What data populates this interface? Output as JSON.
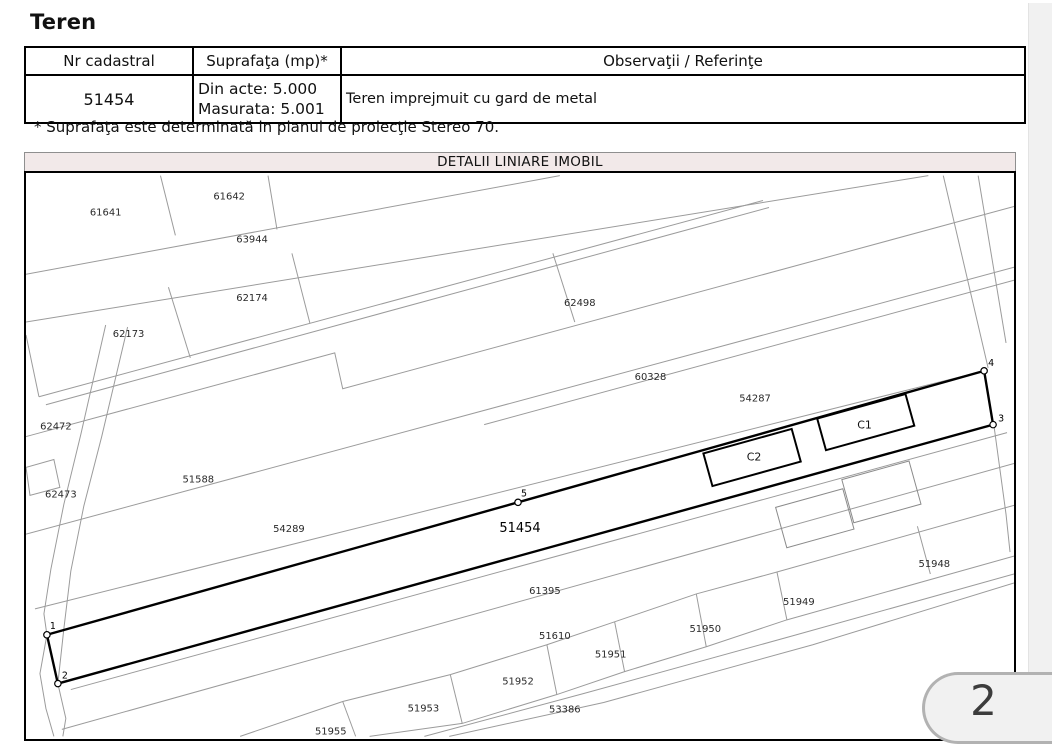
{
  "title": "Teren",
  "table": {
    "headers": [
      "Nr cadastral",
      "Suprafaţa (mp)*",
      "Observaţii / Referinţe"
    ],
    "row": {
      "nr_cadastral": "51454",
      "suprafata_line1": "Din acte: 5.000",
      "suprafata_line2": "Masurata: 5.001",
      "observatii": "Teren imprejmuit cu gard de metal"
    }
  },
  "footnote": "* Suprafaţa este determinată in planul de proiecţie Stereo 70.",
  "page_number": "2",
  "colors": {
    "band_background": "#f2e9e9",
    "gutter_background": "#f1f1f1",
    "parcel_line": "#9b9b9b",
    "main_parcel_line": "#000000",
    "badge_border": "#b2b2b2"
  },
  "map": {
    "title": "DETALII LINIARE IMOBIL",
    "main_parcel": "51454",
    "labels": [
      {
        "text": "61641",
        "x": 80,
        "y": 40
      },
      {
        "text": "61642",
        "x": 204,
        "y": 24
      },
      {
        "text": "63944",
        "x": 227,
        "y": 67
      },
      {
        "text": "62174",
        "x": 227,
        "y": 126
      },
      {
        "text": "62173",
        "x": 103,
        "y": 162
      },
      {
        "text": "62498",
        "x": 556,
        "y": 131
      },
      {
        "text": "60328",
        "x": 627,
        "y": 205
      },
      {
        "text": "54287",
        "x": 732,
        "y": 227
      },
      {
        "text": "62472",
        "x": 30,
        "y": 255
      },
      {
        "text": "62473",
        "x": 35,
        "y": 323
      },
      {
        "text": "51588",
        "x": 173,
        "y": 308
      },
      {
        "text": "54289",
        "x": 264,
        "y": 358
      },
      {
        "text": "51454",
        "x": 496,
        "y": 358,
        "cls": "main"
      },
      {
        "text": "61395",
        "x": 521,
        "y": 420
      },
      {
        "text": "51610",
        "x": 531,
        "y": 465
      },
      {
        "text": "51950",
        "x": 682,
        "y": 458
      },
      {
        "text": "51951",
        "x": 587,
        "y": 484
      },
      {
        "text": "51949",
        "x": 776,
        "y": 431
      },
      {
        "text": "51948",
        "x": 912,
        "y": 393
      },
      {
        "text": "51952",
        "x": 494,
        "y": 511
      },
      {
        "text": "51953",
        "x": 399,
        "y": 538
      },
      {
        "text": "53386",
        "x": 541,
        "y": 539
      },
      {
        "text": "51955",
        "x": 306,
        "y": 561
      },
      {
        "text": "C1",
        "x": 842,
        "y": 254,
        "cls": "building"
      },
      {
        "text": "C2",
        "x": 731,
        "y": 286,
        "cls": "building"
      }
    ],
    "vertices": [
      {
        "label": "1",
        "cx": 21,
        "cy": 461,
        "tx": 24,
        "ty": 455
      },
      {
        "label": "2",
        "cx": 32,
        "cy": 510,
        "tx": 36,
        "ty": 505
      },
      {
        "label": "3",
        "cx": 971,
        "cy": 250,
        "tx": 976,
        "ty": 247
      },
      {
        "label": "4",
        "cx": 962,
        "cy": 196,
        "tx": 966,
        "ty": 191
      },
      {
        "label": "5",
        "cx": 494,
        "cy": 328,
        "tx": 497,
        "ty": 322
      }
    ]
  }
}
